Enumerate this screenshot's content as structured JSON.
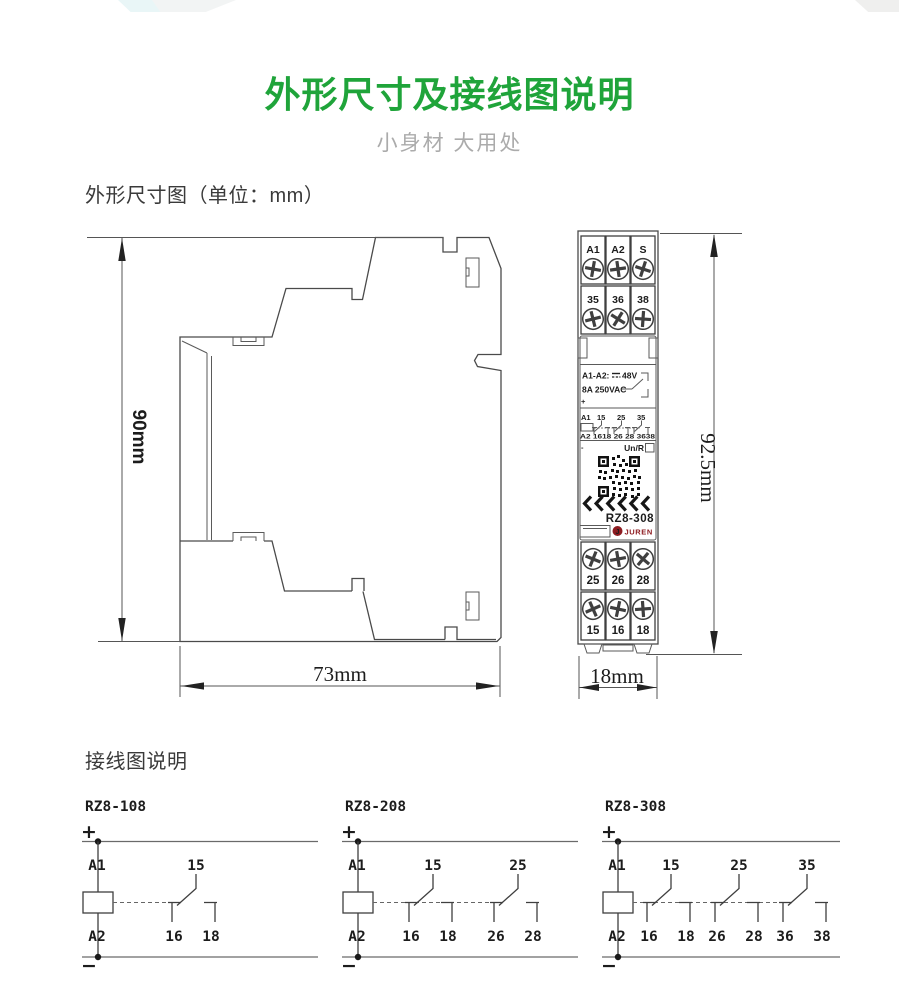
{
  "page": {
    "title": "外形尺寸及接线图说明",
    "subtitle": "小身材 大用处"
  },
  "colors": {
    "title_green": "#1fa43a",
    "brand_red": "#8e1c21"
  },
  "dimensions": {
    "heading": "外形尺寸图（单位：mm）",
    "side_height": "90mm",
    "side_width": "73mm",
    "front_height": "92.5mm",
    "front_width": "18mm"
  },
  "device": {
    "model": "RZ8-308",
    "brand": "JUREN",
    "top_row1": [
      "A1",
      "A2",
      "S"
    ],
    "top_row2": [
      "35",
      "36",
      "38"
    ],
    "bottom_row1": [
      "25",
      "26",
      "28"
    ],
    "bottom_row2": [
      "15",
      "16",
      "18"
    ],
    "rating_prefix": "A1-A2:",
    "rating_voltage": "48V",
    "rating_contact": "8A 250VAC",
    "polarity_plus": "+",
    "polarity_minus": "-",
    "mini_top": [
      "A1",
      "15",
      "25",
      "35"
    ],
    "mini_bottom": "A2 1618 26 28 3638",
    "un_r": "Un/R"
  },
  "wiring": {
    "heading": "接线图说明",
    "diagrams": [
      {
        "model": "RZ8-108",
        "plus": "+",
        "minus": "−",
        "a1": "A1",
        "a2": "A2",
        "contacts": [
          {
            "com": "15",
            "nc": "16",
            "no": "18"
          }
        ]
      },
      {
        "model": "RZ8-208",
        "plus": "+",
        "minus": "−",
        "a1": "A1",
        "a2": "A2",
        "contacts": [
          {
            "com": "15",
            "nc": "16",
            "no": "18"
          },
          {
            "com": "25",
            "nc": "26",
            "no": "28"
          }
        ]
      },
      {
        "model": "RZ8-308",
        "plus": "+",
        "minus": "−",
        "a1": "A1",
        "a2": "A2",
        "contacts": [
          {
            "com": "15",
            "nc": "16",
            "no": "18"
          },
          {
            "com": "25",
            "nc": "26",
            "no": "28"
          },
          {
            "com": "35",
            "nc": "36",
            "no": "38"
          }
        ]
      }
    ]
  }
}
